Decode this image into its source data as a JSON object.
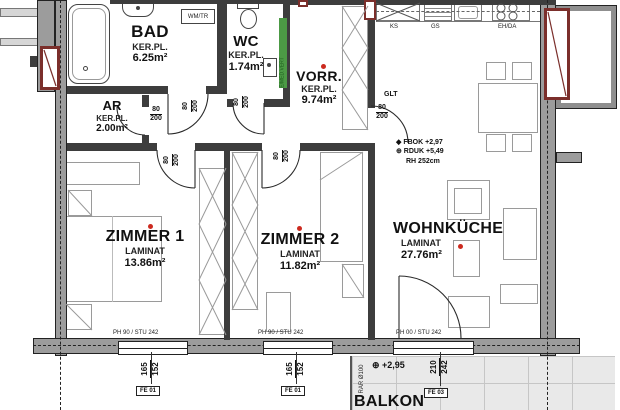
{
  "rooms": {
    "bad": {
      "name": "BAD",
      "floor": "KER.PL.",
      "area": "6.25m²"
    },
    "wc": {
      "name": "WC",
      "floor": "KER.PL.",
      "area": "1.74m²"
    },
    "vorr": {
      "name": "VORR.",
      "floor": "KER.PL.",
      "area": "9.74m²"
    },
    "ar": {
      "name": "AR",
      "floor": "KER.PL.",
      "area": "2.00m²"
    },
    "zimmer1": {
      "name": "ZIMMER 1",
      "floor": "LAMINAT",
      "area": "13.86m²"
    },
    "zimmer2": {
      "name": "ZIMMER 2",
      "floor": "LAMINAT",
      "area": "11.82m²"
    },
    "wohnkueche": {
      "name": "WOHNKÜCHE",
      "floor": "LAMINAT",
      "area": "27.76m²"
    },
    "balkon": {
      "name": "BALKON",
      "level": "⊕ +2,95",
      "drain": "RAR Ø100"
    }
  },
  "kitchen": {
    "ks": "KS",
    "gs": "GS",
    "eh_da": "EH/DA"
  },
  "labels": {
    "wm_tr": "WM/TR",
    "duct": "E/MED.VERT",
    "glt": "GLT"
  },
  "levels": {
    "fbok": "◆ FBOK +2,97",
    "rduk": "⊕ RDUK +5,49",
    "rh": "RH 252cm"
  },
  "door": {
    "num": "80",
    "den": "200"
  },
  "windows": {
    "w1": {
      "head": "PH 90 / STU 242",
      "num": "165",
      "den": "152",
      "tag": "FE 01"
    },
    "w2": {
      "head": "PH 90 / STU 242",
      "num": "165",
      "den": "152",
      "tag": "FE 01"
    },
    "w3": {
      "head": "PH 00 / STU 242",
      "num": "210",
      "den": "242",
      "tag": "FE 03"
    }
  },
  "colors": {
    "shaft_red": "#7b2f2b",
    "duct_green": "#4c9a45",
    "dot_red": "#cc2a1f"
  }
}
